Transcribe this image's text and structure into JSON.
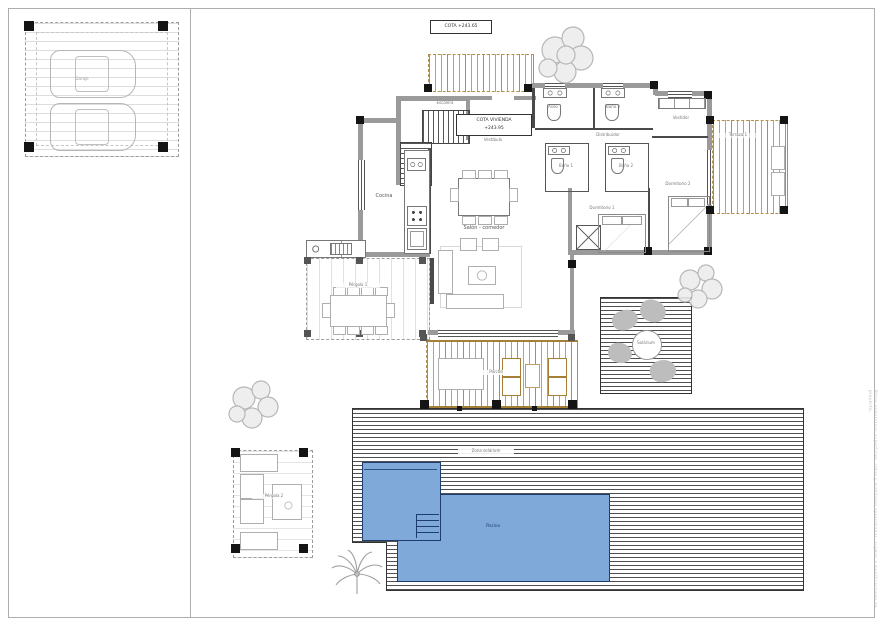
{
  "page": {
    "side_note": "Plano orientativo: superficies, cotas y mobiliario aproximados, sujetos a modificaciones de proyecto."
  },
  "levels": {
    "cota_site": "COTA +243.65",
    "cota_house_title": "COTA VIVIENDA",
    "cota_house_value": "+243.95"
  },
  "rooms": {
    "garaje": "Garaje",
    "escalera": "Escalera",
    "vestibulo": "Vestíbulo",
    "cocina": "Cocina",
    "salon": "Salón - comedor",
    "distribuidor": "Distribuidor",
    "aseo": "Aseo",
    "bano1": "Baño 1",
    "bano2": "Baño 2",
    "bano3": "Baño 3",
    "vestidor": "Vestidor",
    "dorm1": "Dormitorio 1",
    "dorm2": "Dormitorio 2",
    "terraza1": "Terraza 1",
    "porche": "Porche",
    "pergola1": "Pérgola 1",
    "pergola2": "Pérgola 2",
    "solarium": "Solárium",
    "zona_solarium": "Zona solárium",
    "piscina": "Piscina"
  },
  "colors": {
    "pool_fill": "#7fa9d9",
    "pool_edge": "#1d3d6e",
    "wood_slat": "#b9913f",
    "wood_beam": "#a57f35",
    "wall": "#9a9a9a",
    "column": "#141414",
    "furniture": "#aeaeae",
    "tree": "#b0b0b0",
    "deck_line": "#232323",
    "label": "#555555"
  }
}
